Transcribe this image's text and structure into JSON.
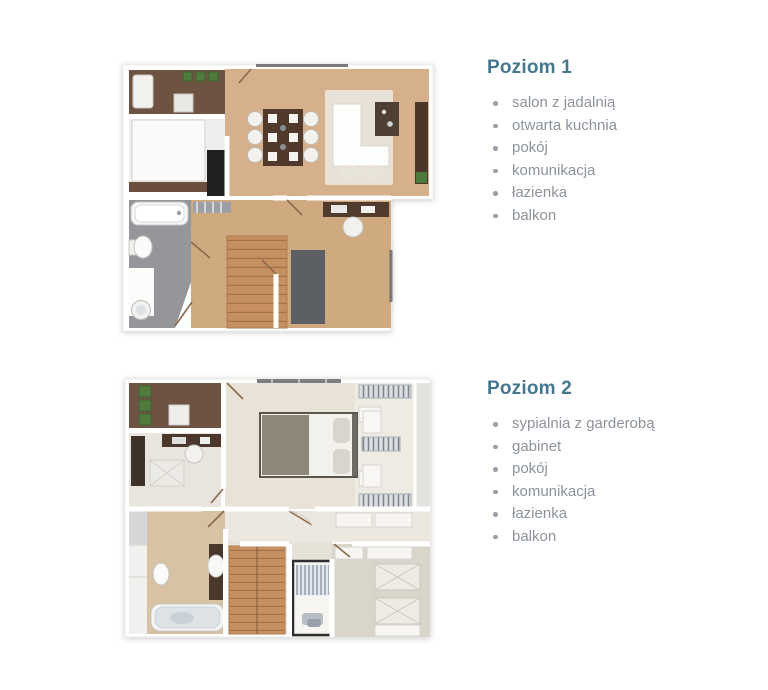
{
  "palette": {
    "accent_heading": "#45788f",
    "list_text": "#8d939b",
    "bullet": "#99a0a7",
    "wood_floor": "#d6b08a",
    "balcony_wood": "#6e5342",
    "stairs_wood": "#c68f60",
    "bathroom1_tile": "#95969a",
    "bathroom2_tile": "#d8c2a4"
  },
  "sections": [
    {
      "heading": "Poziom 1",
      "items": [
        "salon z jadalnią",
        "otwarta kuchnia",
        "pokój",
        "komunikacja",
        "łazienka",
        "balkon"
      ]
    },
    {
      "heading": "Poziom 2",
      "items": [
        "sypialnia z garderobą",
        "gabinet",
        "pokój",
        "komunikacja",
        "łazienka",
        "balkon"
      ]
    }
  ]
}
